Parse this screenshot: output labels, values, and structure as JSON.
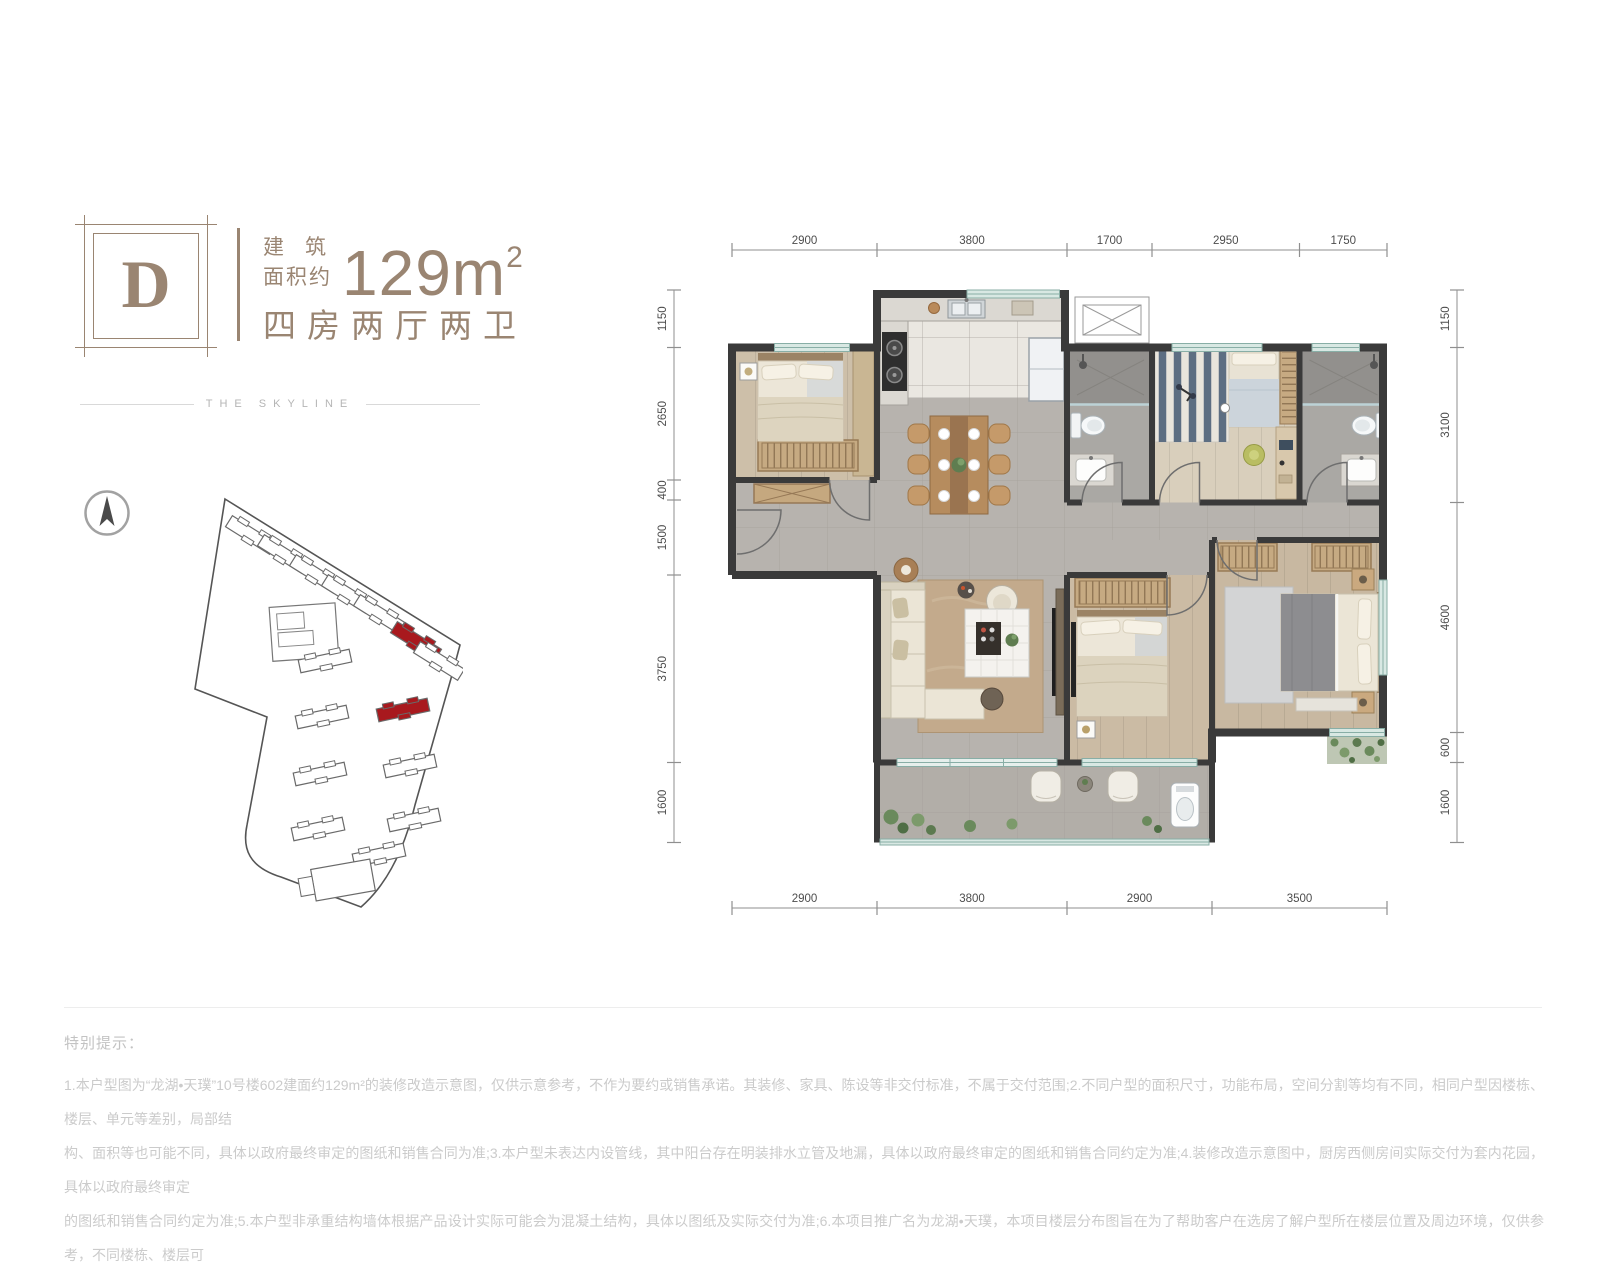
{
  "header": {
    "unit_letter": "D",
    "area_label_line1": "建　筑",
    "area_label_line2": "面积约",
    "area_value": "129m",
    "area_sup": "2",
    "layout_desc": "四房两厅两卫",
    "brand_line": "THE SKYLINE"
  },
  "floor_plan": {
    "dims_top": [
      "2900",
      "3800",
      "1700",
      "2950",
      "1750"
    ],
    "dims_bottom": [
      "2900",
      "3800",
      "2900",
      "3500"
    ],
    "dims_left": [
      "1150",
      "2650",
      "400",
      "1500",
      "3750",
      "1600"
    ],
    "dims_right": [
      "1150",
      "3100",
      "4600",
      "600",
      "1600"
    ]
  },
  "site_plan": {
    "highlighted_building_count": 2
  },
  "compass": {
    "icon": "north-arrow"
  },
  "disclaimer": {
    "title": "特别提示：",
    "lines": [
      "1.本户型图为“龙湖•天璞”10号楼602建面约129m²的装修改造示意图，仅供示意参考，不作为要约或销售承诺。其装修、家具、陈设等非交付标准，不属于交付范围;2.不同户型的面积尺寸，功能布局，空间分割等均有不同，相同户型因楼栋、楼层、单元等差别，局部结",
      "构、面积等也可能不同，具体以政府最终审定的图纸和销售合同为准;3.本户型未表达内设管线，其中阳台存在明装排水立管及地漏，具体以政府最终审定的图纸和销售合同约定为准;4.装修改造示意图中，厨房西侧房间实际交付为套内花园，具体以政府最终审定",
      "的图纸和销售合同约定为准;5.本户型非承重结构墙体根据产品设计实际可能会为混凝土结构，具体以图纸及实际交付为准;6.本项目推广名为龙湖•天璞，本项目楼层分布图旨在为了帮助客户在选房了解户型所在楼层位置及周边环境，仅供参考，不同楼栋、楼层可",
      "能存在差异;本资料发布时间为2022年4月，本公司保留对宣传册修改的权利，敬请留意最新资料，本宣传资料制作时间2022年4月。"
    ]
  },
  "colors": {
    "accent": "#9a8572",
    "dim_text": "#4d4d4d",
    "wall": "#3a3a3a",
    "window": "#d8e8e3",
    "highlight_red": "#a8191e"
  }
}
